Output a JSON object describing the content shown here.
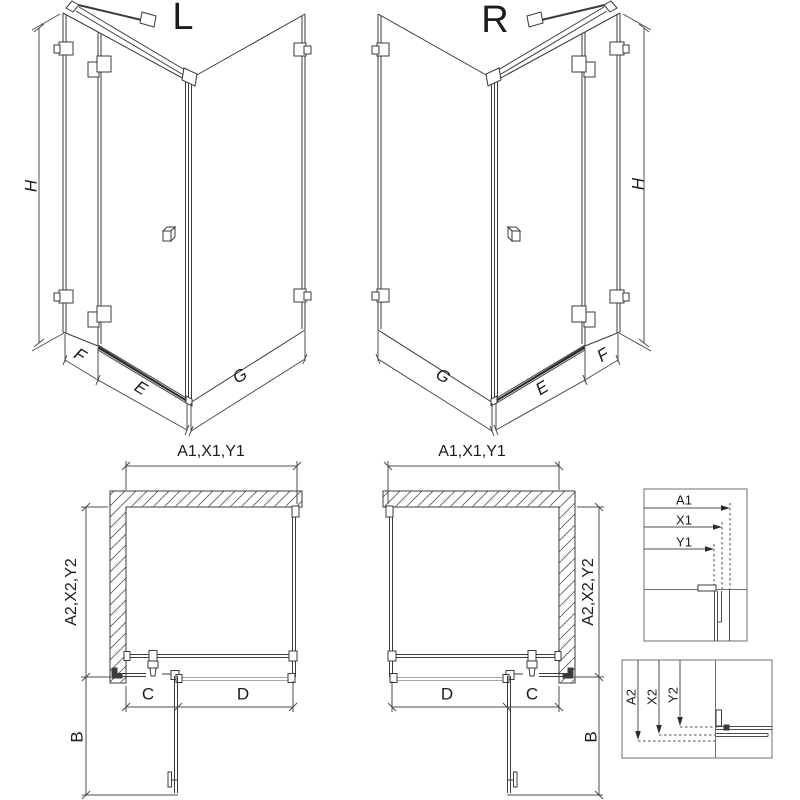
{
  "view_labels": {
    "left": "L",
    "right": "R"
  },
  "iso_dims": {
    "height": "H",
    "fixed_panel": "F",
    "door": "E",
    "side_panel": "G"
  },
  "plan_dims": {
    "width_top": "A1,X1,Y1",
    "depth_side": "A2,X2,Y2",
    "wall_segment": "C",
    "door_segment": "D",
    "door_swing": "B"
  },
  "detail_width": {
    "rows": [
      "A1",
      "X1",
      "Y1"
    ]
  },
  "detail_depth": {
    "rows": [
      "A2",
      "X2",
      "Y2"
    ]
  },
  "colors": {
    "line": "#3b3b3b",
    "dim_line": "#4d4d4d",
    "light_line": "#a9a9a9",
    "text": "#1b1b1b"
  }
}
